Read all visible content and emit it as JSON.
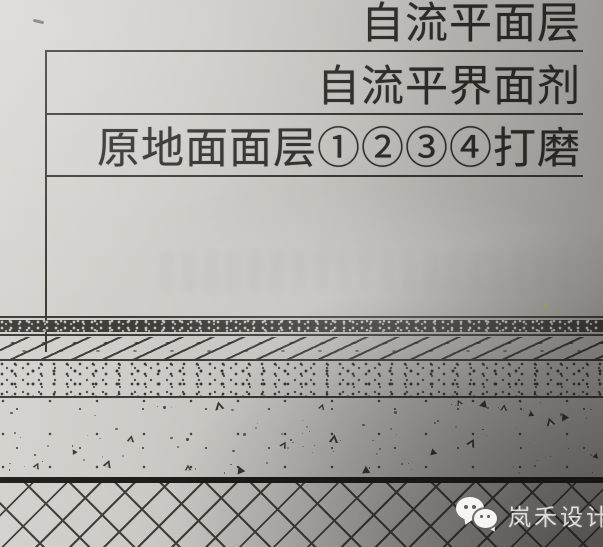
{
  "callouts": {
    "items": [
      {
        "label": "自流平面层"
      },
      {
        "label": "自流平界面剂"
      },
      {
        "label": "原地面面层①②③④打磨"
      }
    ]
  },
  "section_layers": [
    {
      "name": "self-leveling-top-line",
      "pattern": "thin-line"
    },
    {
      "name": "self-leveling-surface-band",
      "pattern": "dark-speckle"
    },
    {
      "name": "interface-agent-line",
      "pattern": "thin-line"
    },
    {
      "name": "original-floor-finish-band",
      "pattern": "diagonal-hatch"
    },
    {
      "name": "mortar-band",
      "pattern": "dense-dots"
    },
    {
      "name": "concrete-band",
      "pattern": "sparse-dots-and-triangles"
    },
    {
      "name": "slab-top-line",
      "pattern": "thick-line"
    },
    {
      "name": "brick-base-band",
      "pattern": "diagonal-brick-hatch"
    }
  ],
  "watermark": {
    "brand": "岚禾设计",
    "icon": "wechat-icon"
  },
  "colors": {
    "ink": "#38362f",
    "thick_line": "#1b1a15",
    "paper_light": "#d9d6d2",
    "paper_dark": "#a3a09c",
    "watermark_text": "#f6f5f2"
  }
}
